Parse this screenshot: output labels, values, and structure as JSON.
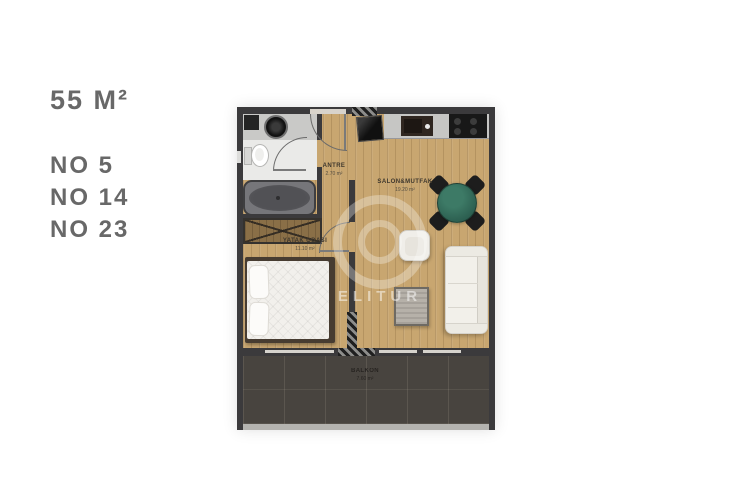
{
  "info": {
    "area_label": "55 M²",
    "units": [
      "NO 5",
      "NO 14",
      "NO 23"
    ]
  },
  "rooms": {
    "antre": {
      "name": "ANTRE",
      "area": "2.70 m²"
    },
    "salon": {
      "name": "SALON&MUTFAK",
      "area": "19.20 m²"
    },
    "bedroom": {
      "name": "YATAK ODASI",
      "area": "11.10 m²"
    },
    "balcony": {
      "name": "BALKON",
      "area": "7.60 m²"
    }
  },
  "watermark": {
    "text": "ELITUR"
  },
  "colors": {
    "info_text": "#686868",
    "wall": "#3b3a3c",
    "wood_floor": "#c8a670",
    "balcony_tile": "#48443f",
    "dining_table_green": "#2e6a58",
    "bath_counter": "#c9c9c7",
    "sofa_white": "#f2f0ea"
  }
}
